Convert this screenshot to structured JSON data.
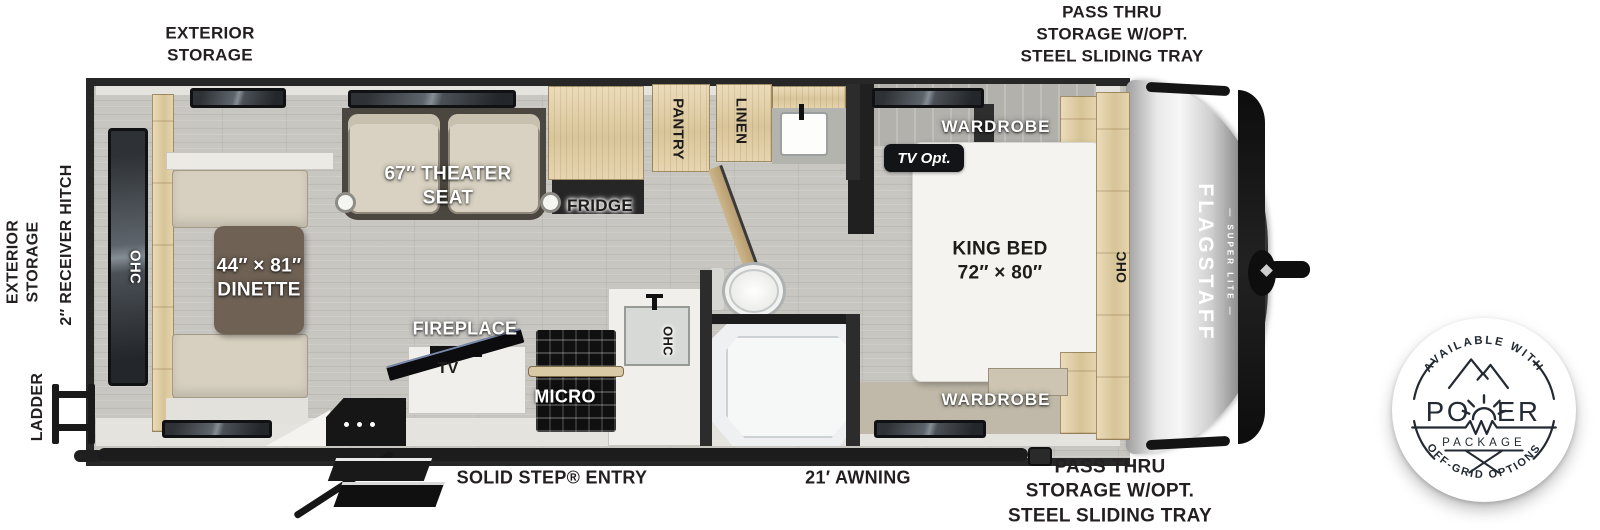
{
  "exterior": {
    "storage_top": "EXTERIOR\nSTORAGE",
    "pass_thru_top": "PASS THRU\nSTORAGE W/OPT.\nSTEEL SLIDING TRAY",
    "pass_thru_bottom": "PASS THRU\nSTORAGE W/OPT.\nSTEEL SLIDING TRAY",
    "storage_left": "EXTERIOR\nSTORAGE",
    "receiver_hitch": "2″ RECEIVER HITCH",
    "ladder": "LADDER",
    "solid_step": "SOLID STEP® ENTRY",
    "awning": "21′ AWNING"
  },
  "interior": {
    "ohc_rear": "OHC",
    "dinette": "44″ × 81″\nDINETTE",
    "theater_seat": "67″ THEATER\nSEAT",
    "fridge": "FRIDGE",
    "pantry": "PANTRY",
    "linen": "LINEN",
    "wardrobe_front_top": "WARDROBE",
    "tv_opt": "TV Opt.",
    "king_bed": "KING BED\n72″ × 80″",
    "ohc_bed": "OHC",
    "fireplace": "FIREPLACE",
    "tv": "TV",
    "micro": "MICRO",
    "ohc_kitchen": "OHC",
    "wardrobe_front_bottom": "WARDROBE"
  },
  "branding": {
    "model": "FLAGSTAFF",
    "series": "SUPER LITE"
  },
  "badge": {
    "arc_top": "AVAILABLE WITH",
    "power_left": "PO",
    "power_right": "ER",
    "package": "PACKAGE",
    "arc_bottom": "OFF-GRID OPTIONS"
  },
  "colors": {
    "ink": "#231f20",
    "badge_ink": "#232a33",
    "floor": "#c8c6c1",
    "wood": "#e2d0a9",
    "appliance_dark": "#1c1c1c"
  }
}
